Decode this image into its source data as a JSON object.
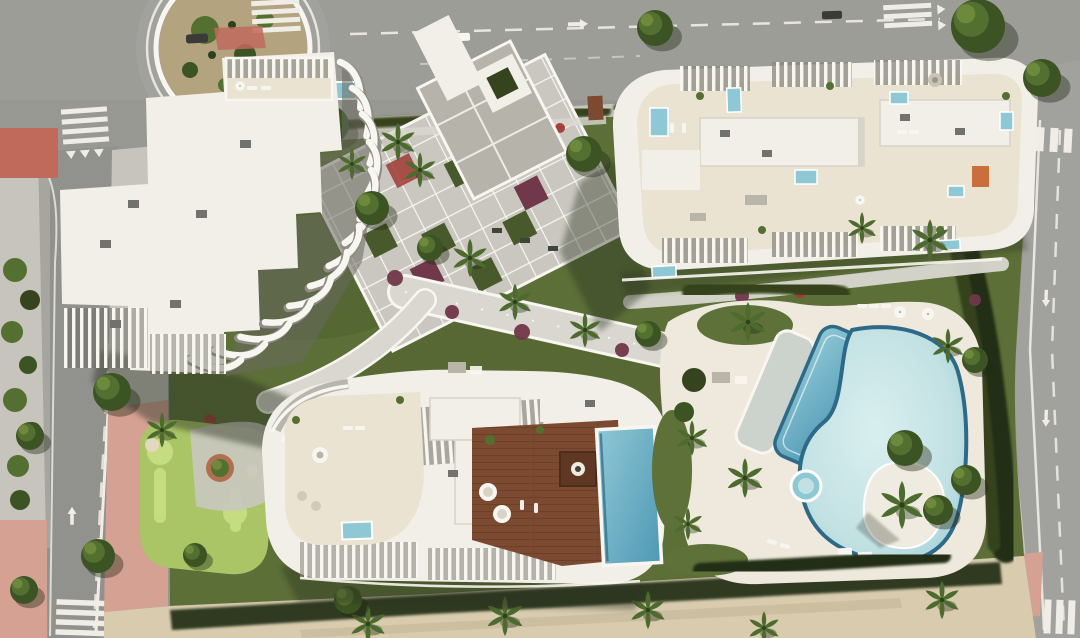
{
  "scene": {
    "kind": "aerial-architectural-render",
    "features": [
      "roundabout",
      "top-road",
      "left-road",
      "right-road",
      "building-a-curved-fins",
      "building-b-rooftop-terraces",
      "building-c-rooftop-deck",
      "central-walkway-grid",
      "mini-golf-green",
      "lagoon-pool",
      "lap-pool",
      "jacuzzi",
      "pool-island",
      "beach-promenade",
      "garden-hedges",
      "palm-trees"
    ]
  },
  "colors": {
    "asphalt": "#a1a19d",
    "asphalt_dark": "#8d8d89",
    "marking": "#efede6",
    "sidewalk": "#c6c4bc",
    "pink_pavement": "#d5a193",
    "red_pavement": "#c06a5c",
    "lawn": "#5e7138",
    "lawn_dark": "#48592b",
    "putting_green": "#a9c566",
    "putting_light": "#c6dc80",
    "bunker_sand": "#e3d9bd",
    "hedge": "#36431f",
    "hedge_dark": "#242e14",
    "path": "#c9c7bf",
    "path_light": "#d9d7d0",
    "white_trim": "#f8f6f0",
    "roof_white": "#f2efe8",
    "roof_shadow": "#d7d3c7",
    "terrace": "#ebe3d1",
    "gray_paving": "#b5b3aa",
    "ac_unit": "#71716d",
    "wood_deck": "#7c4a30",
    "wood_dark": "#5f3722",
    "pool_light": "#c2e1e3",
    "pool_mid": "#8fc8d5",
    "pool_deep": "#4f98b5",
    "pool_rim": "#2e6a88",
    "island_sand": "#f0ebe0",
    "deck_white": "#eee9dc",
    "sand": "#d8cbae",
    "sand_dark": "#c9bb9c",
    "tree_dark": "#3c5323",
    "tree_mid": "#547030",
    "tree_light": "#6d8a3c",
    "palm_green": "#4d6b2e",
    "flower_red": "#a03a33",
    "flower_maroon": "#71374a",
    "planter_terracotta": "#b06f4e",
    "furniture_orange": "#c4652f",
    "shadow_dark": "#2c3320",
    "vehicle_dark": "#3a3a38"
  }
}
